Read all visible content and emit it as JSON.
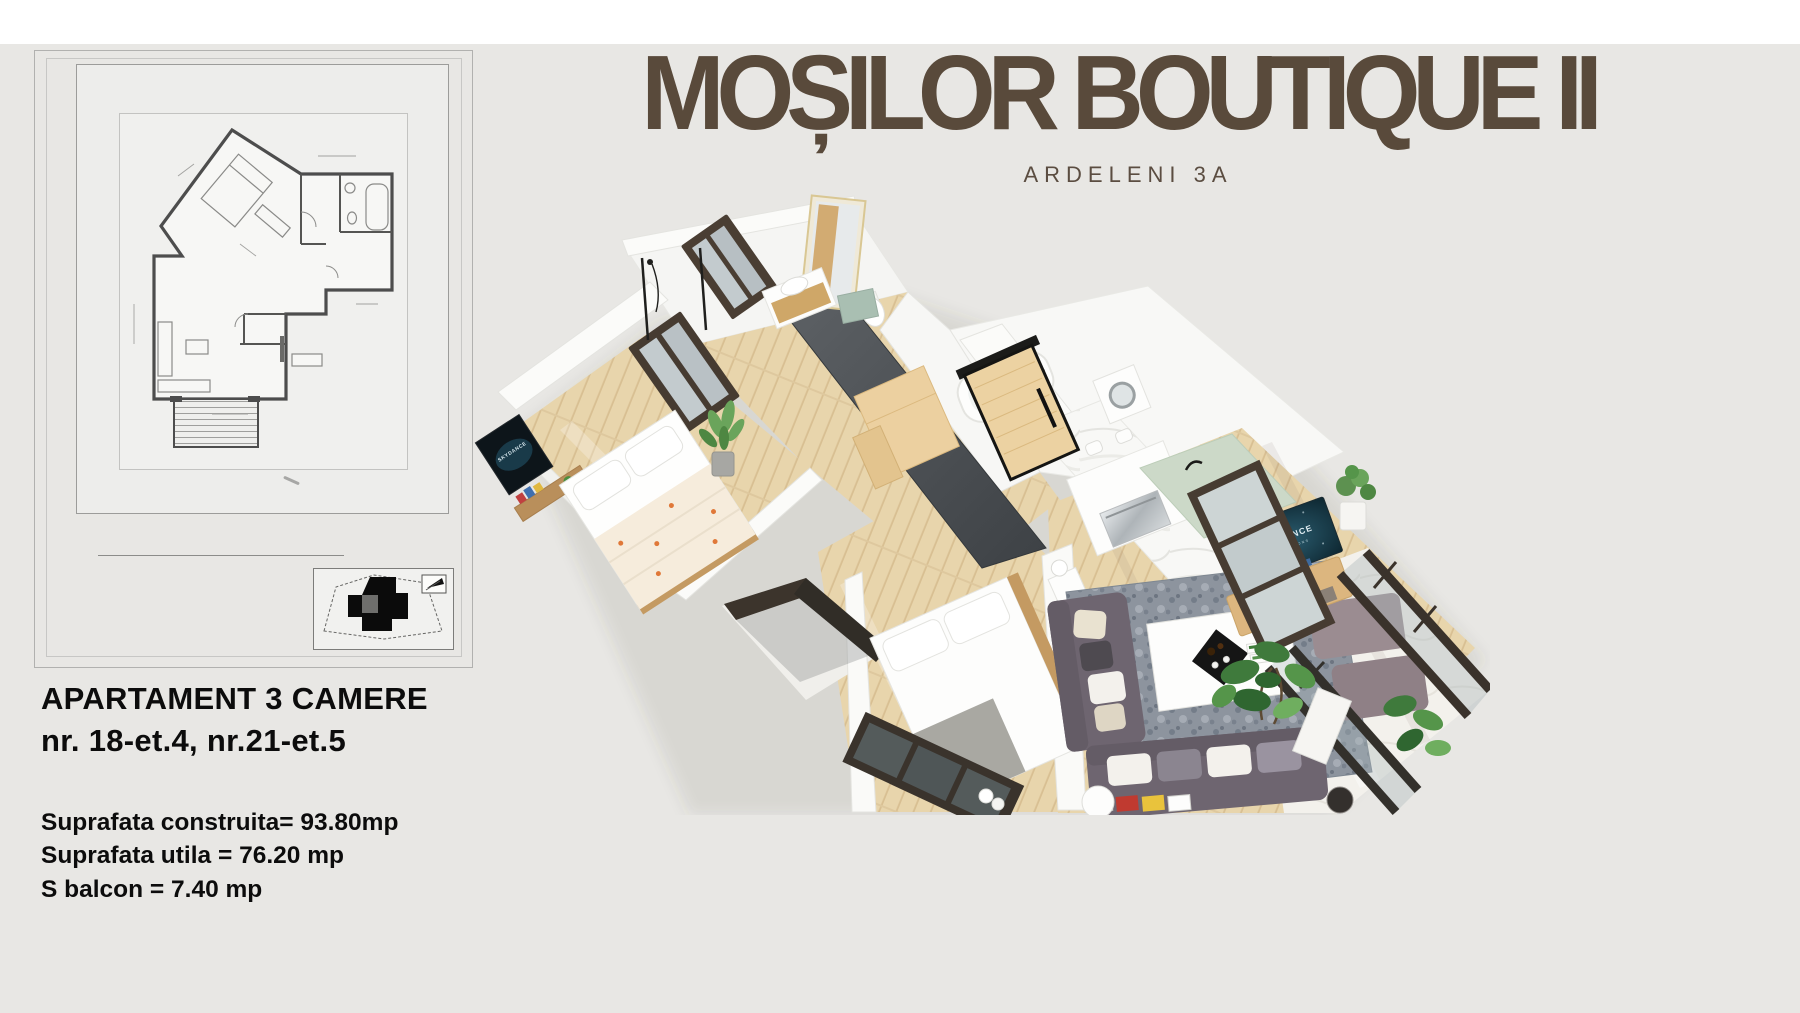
{
  "page": {
    "background": "#e8e7e4",
    "top_band": "#ffffff",
    "brand_color": "#594a3b"
  },
  "header": {
    "title": "MOȘILOR BOUTIQUE II",
    "subtitle": "ARDELENI 3A"
  },
  "apartment": {
    "heading": "APARTAMENT 3 CAMERE",
    "units": "nr. 18-et.4, nr.21-et.5",
    "areas": [
      "Suprafata construita= 93.80mp",
      "Suprafata utila = 76.20 mp",
      "S balcon = 7.40 mp"
    ]
  },
  "render": {
    "tv_brand": "SKYDANCE",
    "tv_brand_sub": "PRODUCTIONS"
  }
}
